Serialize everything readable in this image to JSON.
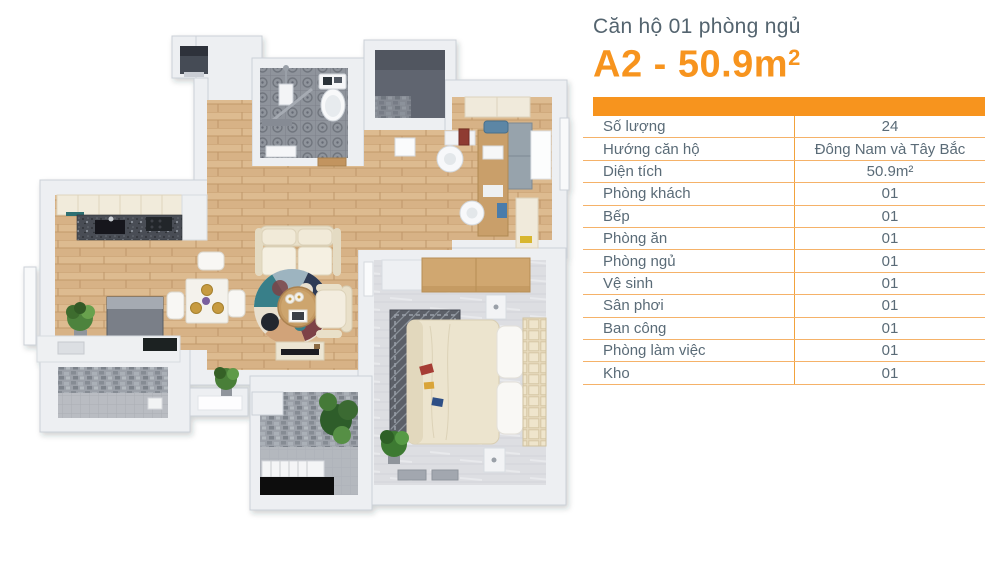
{
  "header": {
    "subtitle": "Căn hộ 01 phòng ngủ",
    "title_main": "A2 - 50.9m",
    "title_sup": "2"
  },
  "table": {
    "rows": [
      {
        "label": "Số lượng",
        "value": "24"
      },
      {
        "label": "Hướng căn hộ",
        "value": "Đông Nam và Tây Bắc"
      },
      {
        "label": "Diện tích",
        "value": "50.9m²"
      },
      {
        "label": "Phòng khách",
        "value": "01"
      },
      {
        "label": "Bếp",
        "value": "01"
      },
      {
        "label": "Phòng ăn",
        "value": "01"
      },
      {
        "label": "Phòng ngủ",
        "value": "01"
      },
      {
        "label": "Vệ sinh",
        "value": "01"
      },
      {
        "label": "Sân phơi",
        "value": "01"
      },
      {
        "label": "Ban công",
        "value": "01"
      },
      {
        "label": "Phòng làm việc",
        "value": "01"
      },
      {
        "label": "Kho",
        "value": "01"
      }
    ]
  },
  "colors": {
    "accent": "#F7941E",
    "title_text": "#54646F",
    "table_text": "#5A6B77",
    "grid_line": "#F5B269",
    "divider_line": "#F2A23C"
  }
}
